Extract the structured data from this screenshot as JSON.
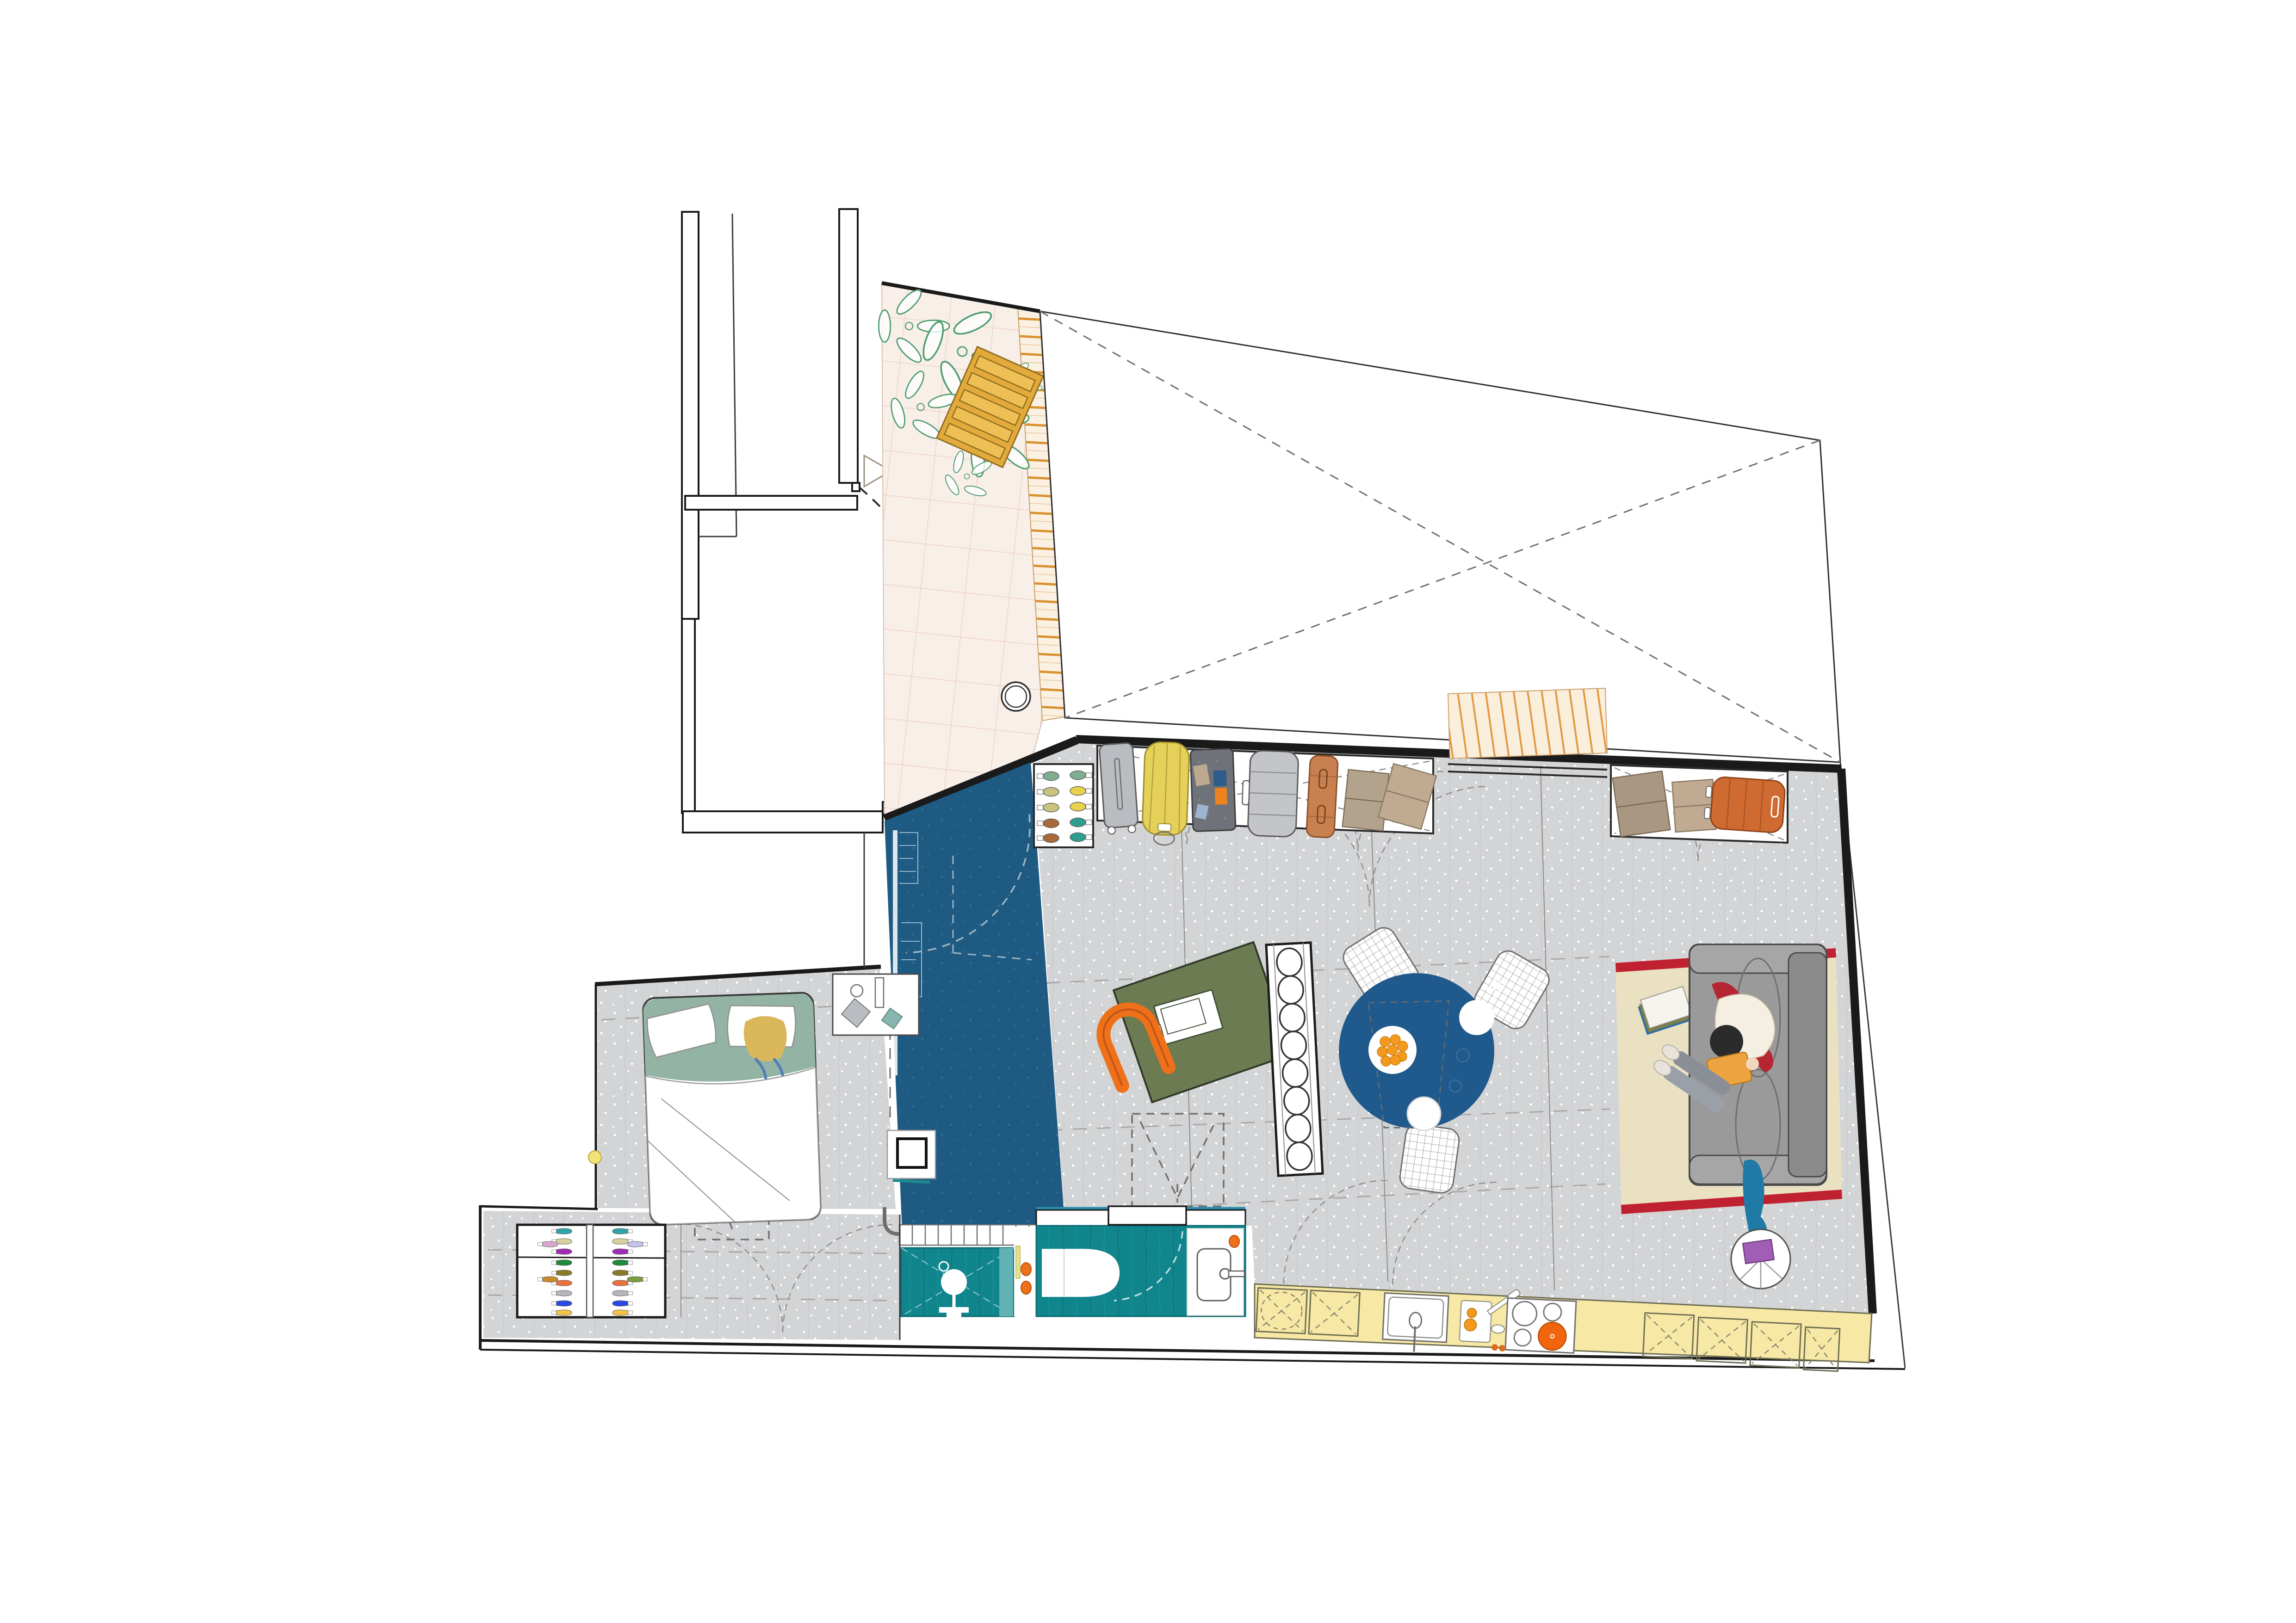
{
  "title": "Apartment floor plan — studio with terrace, entry hall, living room, bedroom, corridor, shower, bathroom and kitchen",
  "palette": {
    "paper": "#ffffff",
    "ink": "#1a1a1a",
    "navy": "#1e5a82",
    "navy-dot": "#306f96",
    "gray-floor": "#d3d4d6",
    "teal": "#10858c",
    "teal-light": "#62b1b5",
    "pink-tile": "#f9efe9",
    "pink-grid": "#ecccbb",
    "slat-bg": "#fbf1e3",
    "slat": "#d8912f",
    "stripe2": "#e39a45",
    "kitchen-yellow": "#f8e8a6",
    "rug": "#eae1c3",
    "rug-red": "#c02130",
    "sofa": "#9a9a9a",
    "sofa-dark": "#8b8b8b",
    "table-navy": "#20598b",
    "desk-green": "#6d7b52",
    "orange": "#ee7019",
    "duffel": "#e5d159",
    "wood": "#e2a93b",
    "plant": "#4f9e72",
    "headboard": "#93b4a4",
    "beige": "#c0ab92",
    "brown-case": "#c06a38",
    "crate": "#6f7278",
    "hair-blond": "#d9b75a",
    "hair-black": "#2b2b2b",
    "book-orange": "#eda33f",
    "purple": "#a05fb5",
    "blanket-red": "#b52532",
    "blanket-blue": "#1f7aa6"
  },
  "rooms": [
    {
      "id": "stairwell",
      "name": "stair landing"
    },
    {
      "id": "terrace",
      "name": "tiled terrace with plants and pallet bench"
    },
    {
      "id": "roof-void",
      "name": "open roof void marked with dashed X"
    },
    {
      "id": "entry-hall",
      "name": "entry hall with navy floor and wardrobe"
    },
    {
      "id": "living-room",
      "name": "living room with gray speckled floor"
    },
    {
      "id": "bedroom",
      "name": "bedroom with double bed"
    },
    {
      "id": "corridor",
      "name": "corridor with shoe rack"
    },
    {
      "id": "shower-room",
      "name": "teal walk-in shower"
    },
    {
      "id": "bathroom",
      "name": "teal bathroom with toilet and vanity"
    },
    {
      "id": "kitchen",
      "name": "kitchen counter run along bottom wall"
    }
  ],
  "furniture": [
    {
      "name": "storage wall: small shoe cabinet",
      "items": "5 pairs of shoes"
    },
    {
      "name": "storage wall: luggage bay",
      "items": "gray trolley, yellow duffel, storage crate, gray case, leather case, folded blankets"
    },
    {
      "name": "storage wall: right bay",
      "items": "two folded blankets, orange suitcase"
    },
    {
      "name": "desk with laptop and orange chair"
    },
    {
      "name": "shelf column with 8 round boxes"
    },
    {
      "name": "round dining table",
      "items": "fruit plate, 2 plates, cutlery, 3 rattan chairs"
    },
    {
      "name": "rug with red end stripes",
      "items": "3 books"
    },
    {
      "name": "gray sofa",
      "items": "person reading orange book, red blanket, blue blanket"
    },
    {
      "name": "round side table with purple book"
    },
    {
      "name": "kitchen run",
      "items": "washing-machine cabinet, 5 X-door cabinets, sink, cutting board with orange, cooktop with 3 burners and orange pot"
    },
    {
      "name": "double bed",
      "items": "2 pillows, sleeping person, green headboard"
    },
    {
      "name": "bedside table"
    },
    {
      "name": "hall shoe rack",
      "items": "14 pairs of colorful shoes"
    },
    {
      "name": "radiator"
    },
    {
      "name": "structural column"
    },
    {
      "name": "toilet"
    },
    {
      "name": "vanity with sink"
    },
    {
      "name": "shower fixture"
    },
    {
      "name": "terrace plants"
    },
    {
      "name": "pallet bench"
    },
    {
      "name": "floor drain"
    }
  ],
  "counts": {
    "shoe_pairs_top_cabinet": 5,
    "shoe_pairs_hall_rack": 14,
    "cooktop_burners": 4,
    "shelf_boxes": 8,
    "rattan_chairs": 3,
    "skylight_projections": 3
  }
}
